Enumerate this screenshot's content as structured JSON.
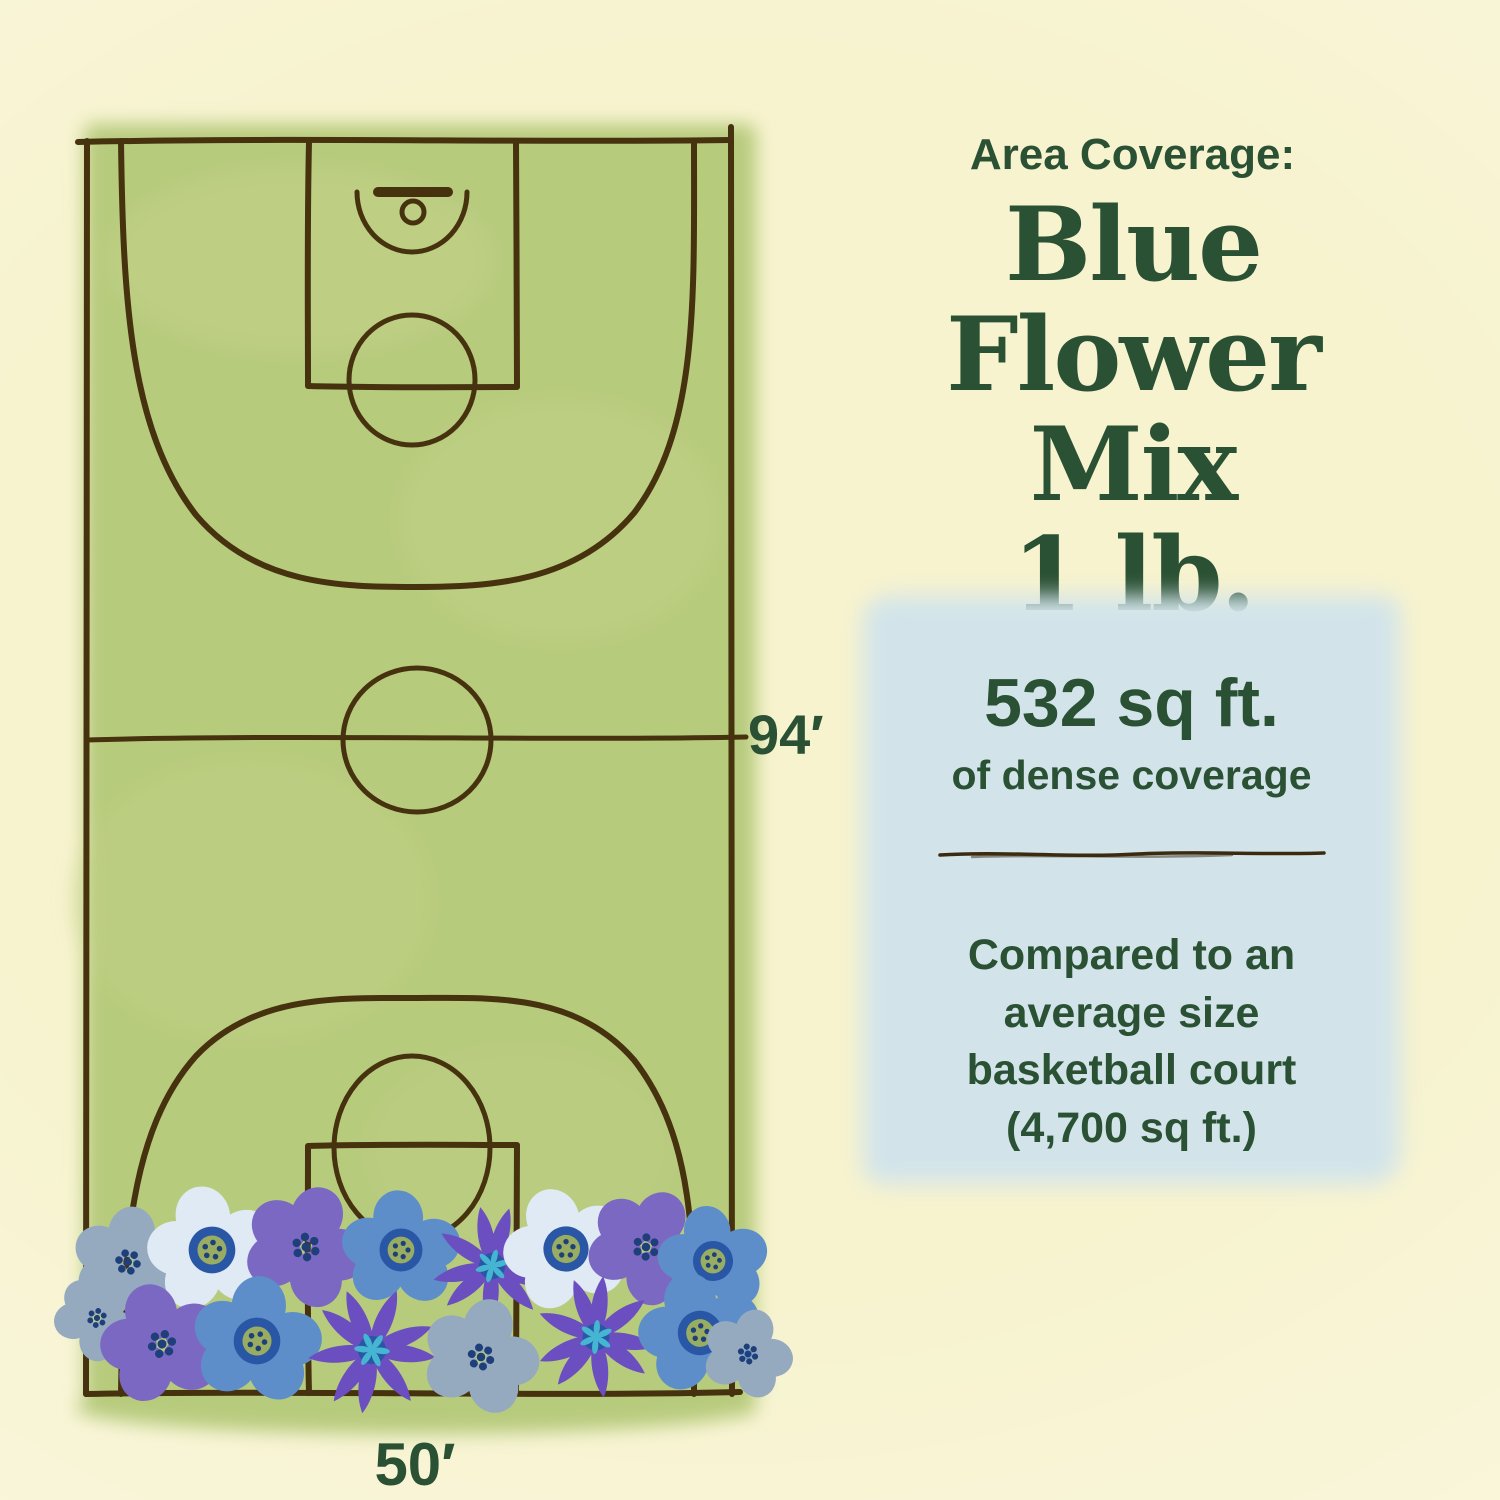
{
  "palette": {
    "background": "#f7f3cf",
    "court_green": "#b7cb7d",
    "line_brown": "#46320f",
    "text_green": "#2b5134",
    "box_blue": "#d2e4ea",
    "divider_brown": "#3b2a10",
    "flower_blue": "#5d8ec9",
    "flower_violet": "#7b68c2",
    "flower_white": "#dfeaf4",
    "flower_gray_blue": "#96aabf",
    "flower_purple": "#6b4fc0",
    "center_navy": "#1f3f7a",
    "center_ring": "#2a57a5",
    "center_olive": "#98ad62",
    "center_teal": "#45b5d2"
  },
  "header": {
    "eyebrow": "Area Coverage:",
    "title_lines": [
      "Blue",
      "Flower Mix",
      "1 lb."
    ]
  },
  "court": {
    "height_label": "94′",
    "width_label": "50′"
  },
  "coverage_box": {
    "headline": "532 sq ft.",
    "subhead": "of dense coverage",
    "comparison_lines": [
      "Compared to an",
      "average size",
      "basketball court",
      "(4,700 sq ft.)"
    ]
  },
  "flowers": [
    {
      "type": "round",
      "x": 128,
      "y": 1262,
      "r": 54,
      "rot": 12,
      "petal": "gray_blue",
      "center": "dots"
    },
    {
      "type": "round",
      "x": 212,
      "y": 1250,
      "r": 63,
      "rot": -10,
      "petal": "white",
      "center": "ring"
    },
    {
      "type": "round",
      "x": 306,
      "y": 1247,
      "r": 60,
      "rot": 24,
      "petal": "violet",
      "center": "dots"
    },
    {
      "type": "round",
      "x": 401,
      "y": 1250,
      "r": 58,
      "rot": 0,
      "petal": "blue",
      "center": "ring"
    },
    {
      "type": "aster",
      "x": 492,
      "y": 1266,
      "r": 60,
      "rot": 15,
      "petal": "purple",
      "center": "star"
    },
    {
      "type": "round",
      "x": 566,
      "y": 1249,
      "r": 61,
      "rot": -18,
      "petal": "white",
      "center": "ring"
    },
    {
      "type": "round",
      "x": 646,
      "y": 1247,
      "r": 57,
      "rot": 32,
      "petal": "violet",
      "center": "dots"
    },
    {
      "type": "round",
      "x": 713,
      "y": 1261,
      "r": 54,
      "rot": -6,
      "petal": "blue",
      "center": "ring"
    },
    {
      "type": "round",
      "x": 97,
      "y": 1318,
      "r": 42,
      "rot": 40,
      "petal": "gray_blue",
      "center": "dots"
    },
    {
      "type": "round",
      "x": 162,
      "y": 1344,
      "r": 60,
      "rot": -14,
      "petal": "violet",
      "center": "dots"
    },
    {
      "type": "round",
      "x": 257,
      "y": 1341,
      "r": 63,
      "rot": 8,
      "petal": "blue",
      "center": "ring"
    },
    {
      "type": "aster",
      "x": 372,
      "y": 1350,
      "r": 64,
      "rot": -25,
      "petal": "purple",
      "center": "star"
    },
    {
      "type": "round",
      "x": 481,
      "y": 1357,
      "r": 57,
      "rot": 18,
      "petal": "gray_blue",
      "center": "dots"
    },
    {
      "type": "aster",
      "x": 596,
      "y": 1337,
      "r": 61,
      "rot": 5,
      "petal": "purple",
      "center": "star"
    },
    {
      "type": "round",
      "x": 700,
      "y": 1333,
      "r": 60,
      "rot": -12,
      "petal": "blue",
      "center": "ring"
    },
    {
      "type": "round",
      "x": 748,
      "y": 1354,
      "r": 44,
      "rot": 20,
      "petal": "gray_blue",
      "center": "dots"
    }
  ]
}
